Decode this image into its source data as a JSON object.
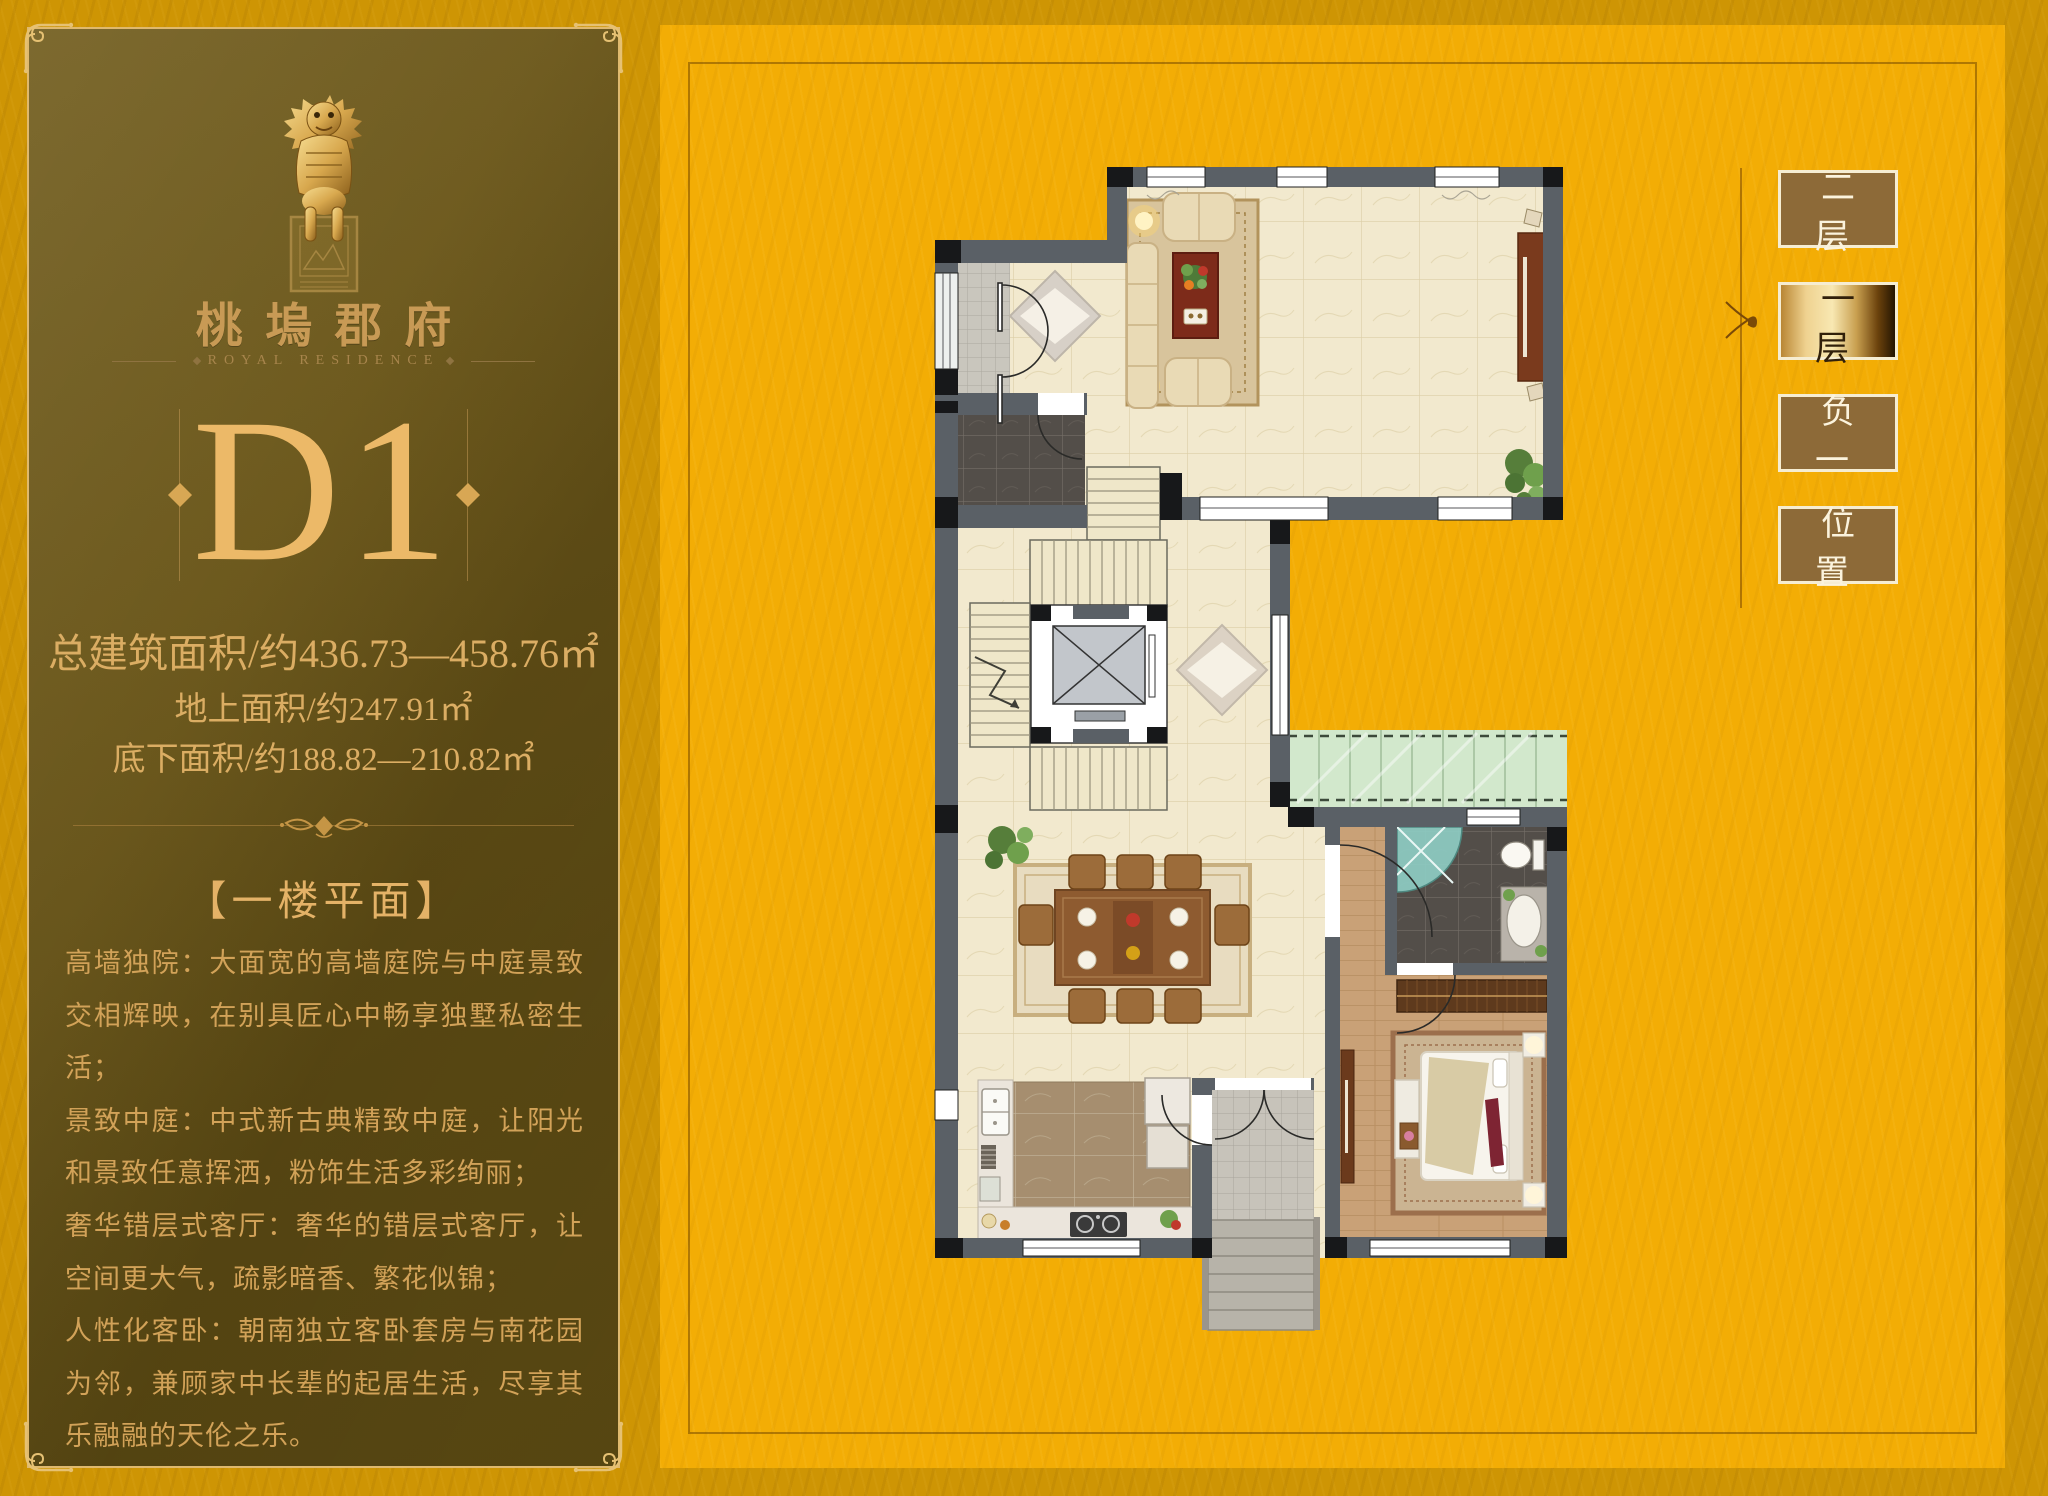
{
  "sidebar": {
    "brand": {
      "logo_icon": "qilin-statue-seal",
      "name": "桃塢郡府",
      "name_en": "ROYAL RESIDENCE"
    },
    "unit_code": "D1",
    "area_lines": {
      "total": "总建筑面积/约436.73—458.76㎡",
      "above_ground": "地上面积/约247.91㎡",
      "basement": "底下面积/约188.82—210.82㎡"
    },
    "section_title": "【一楼平面】",
    "features": [
      "高墙独院：大面宽的高墙庭院与中庭景致交相辉映，在别具匠心中畅享独墅私密生活；",
      "景致中庭：中式新古典精致中庭，让阳光和景致任意挥洒，粉饰生活多彩绚丽；",
      "奢华错层式客厅：奢华的错层式客厅，让空间更大气，疏影暗香、繁花似锦；",
      "人性化客卧：朝南独立客卧套房与南花园为邻，兼顾家中长辈的起居生活，尽享其乐融融的天伦之乐。"
    ]
  },
  "floor_nav": {
    "items": [
      {
        "label": "二层",
        "active": false
      },
      {
        "label": "一层",
        "active": true
      },
      {
        "label": "负一",
        "active": false
      },
      {
        "label": "位置",
        "active": false
      }
    ]
  },
  "colors": {
    "page_bg": "#CE9504",
    "mat_bg": "#F3AD05",
    "panel_dark": "#64511A",
    "panel_border_gold": "#DFB96E",
    "text_gold": "#D8A85D",
    "unit_gold": "#ECB968",
    "button_brown": "#8D6A38",
    "button_border": "#F6EDD2",
    "active_button_gold": "#F8E8B2",
    "wall_gray": "#5A6066"
  }
}
